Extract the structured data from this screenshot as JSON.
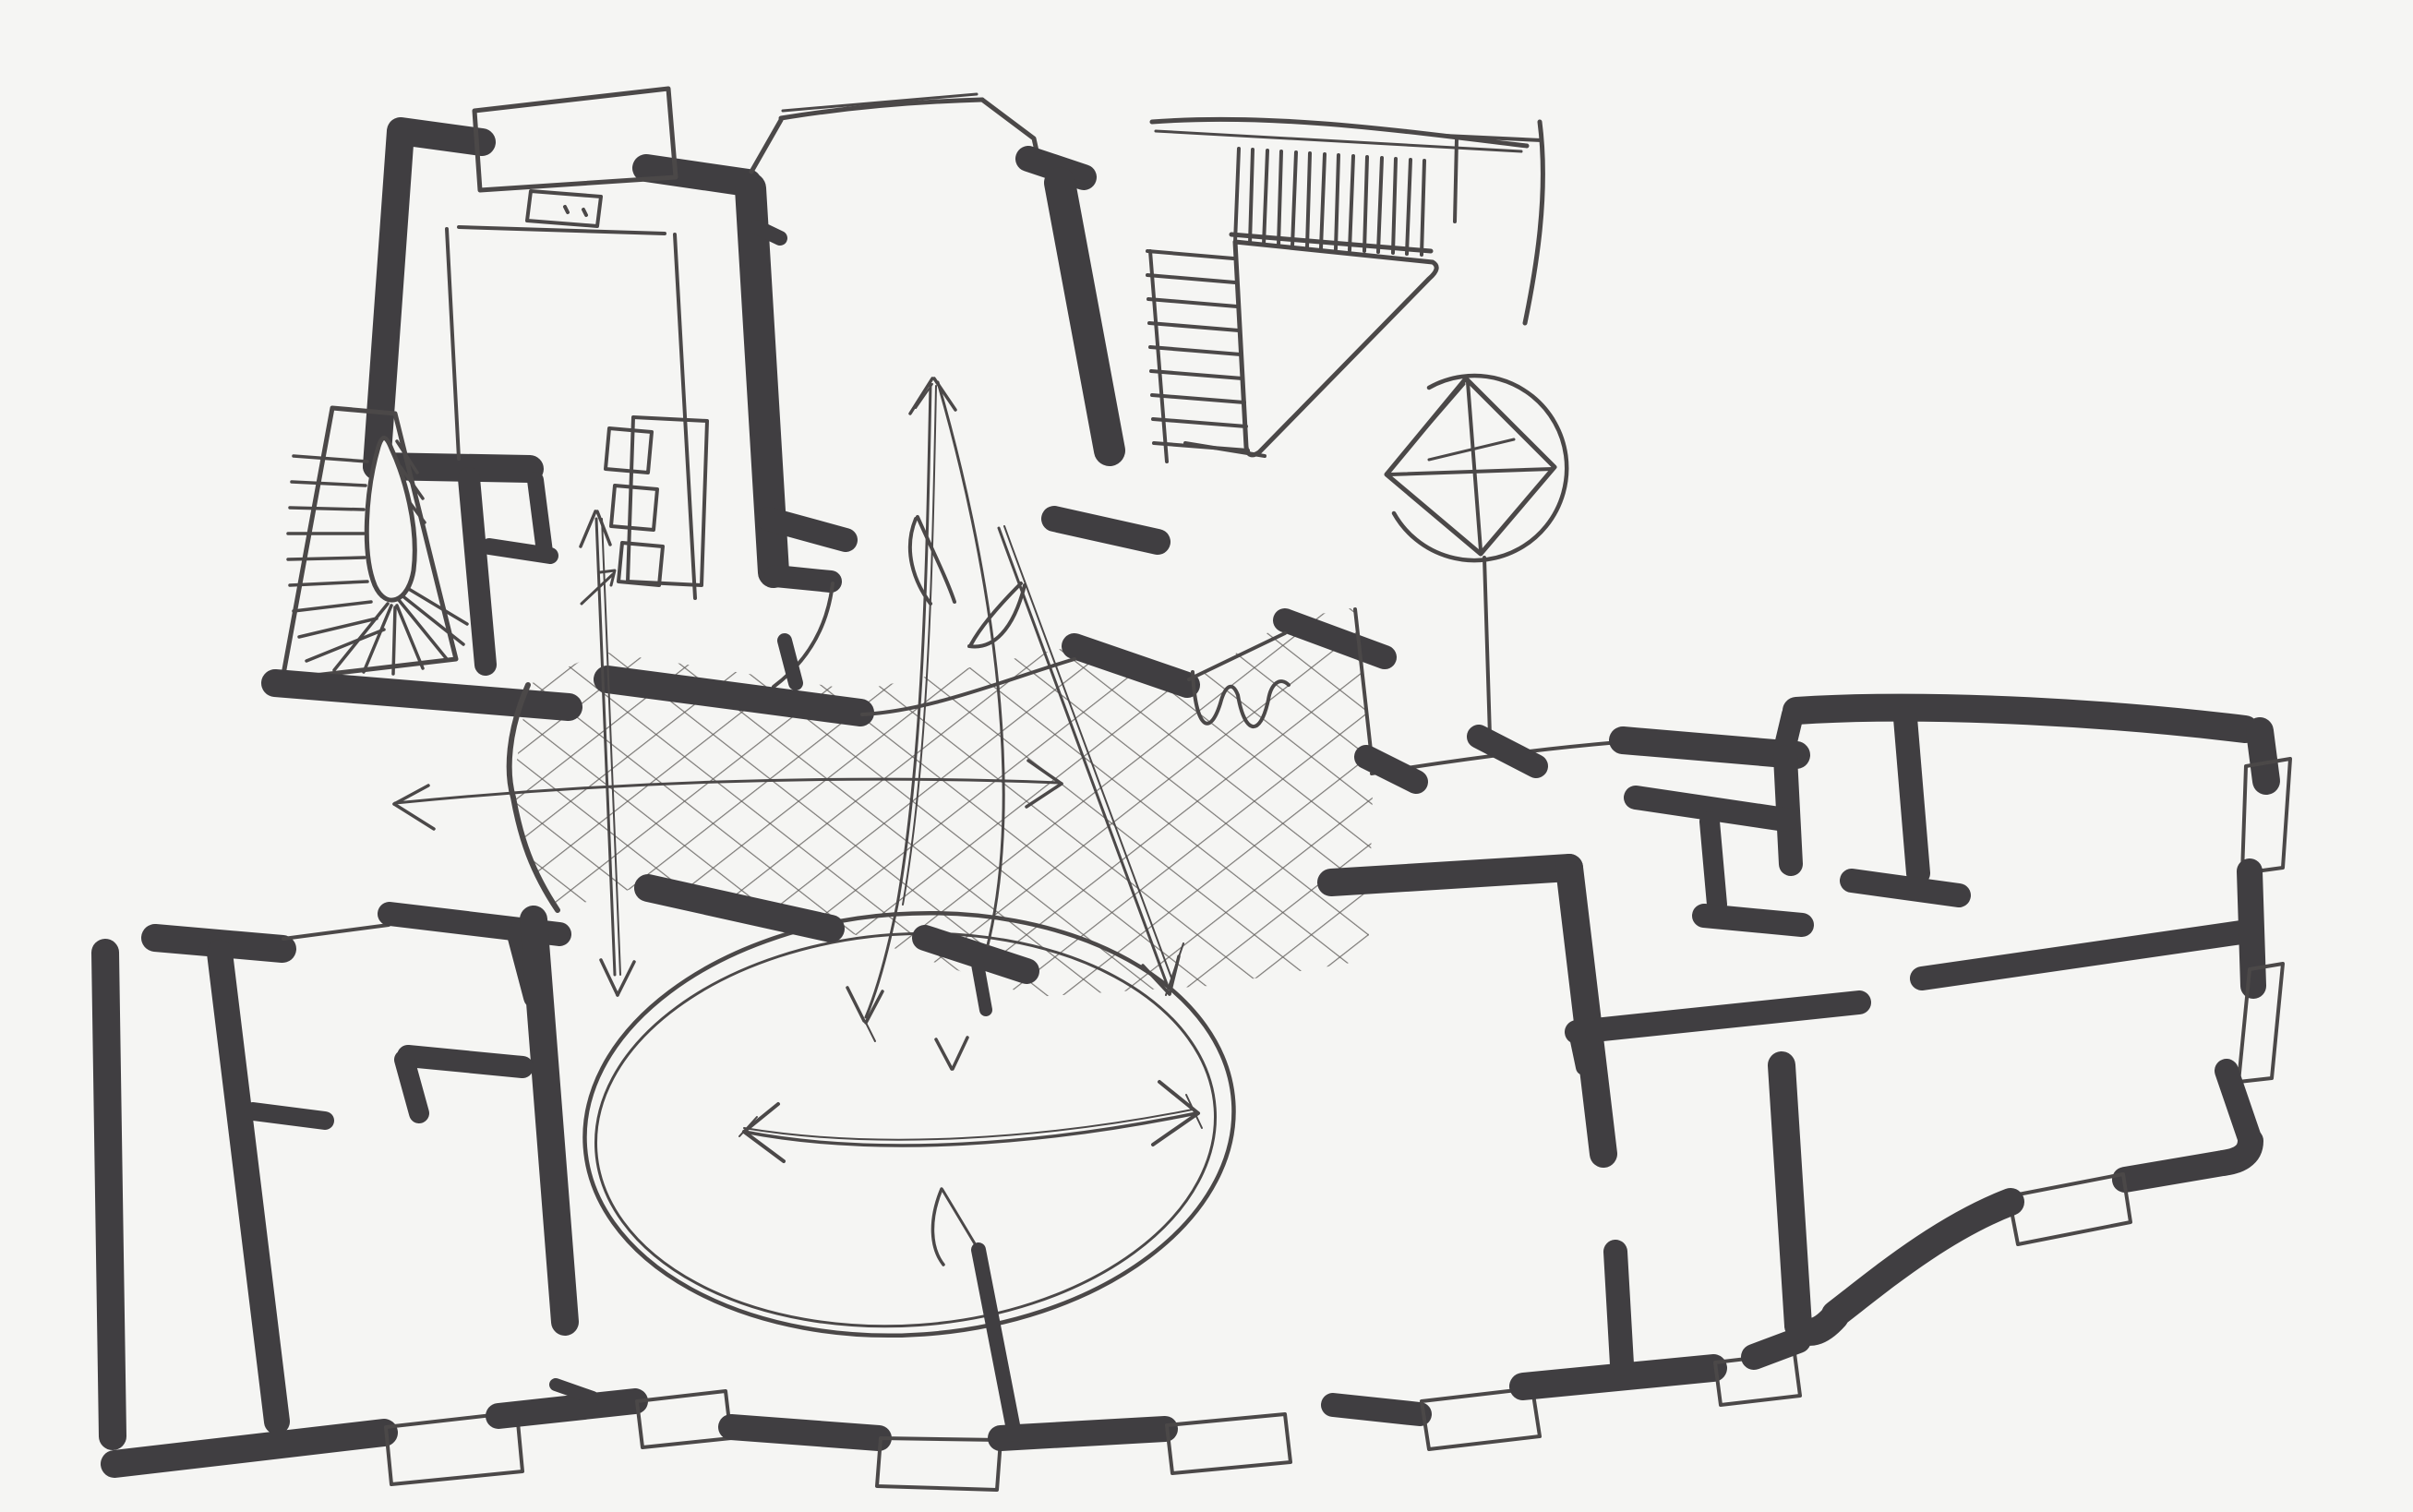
{
  "sketch": {
    "aria_label": "Hand-drawn architectural floor plan sketch with cross-hatched plaza, oval courtyard and flow arrows",
    "colors": {
      "paper": "#f5f5f3",
      "ink": "#403e41",
      "ink_soft": "#4b4848",
      "hatch": "#5d5a57"
    },
    "elements": {
      "entry_vestibule": "room with double door opening and label plate",
      "winding_stair": "fan-tread stair with teardrop newel",
      "center_hall": "hall with bay top and double-door leaves",
      "stair_hall": "straight stair runs with landing triangle",
      "shaft": "diamond with cross inside a circle",
      "plaza": "cross-hatched zone",
      "courtyard": "double-line ellipse",
      "arrows": "flow arrows (vertical, fan, diagonal, horizontal, up)",
      "west_rooms": "lower-left room block",
      "east_wing": "right wing rooms",
      "south_facade": "dashed wall with window rectangles",
      "shelf": "small shelf with three boxes"
    }
  }
}
